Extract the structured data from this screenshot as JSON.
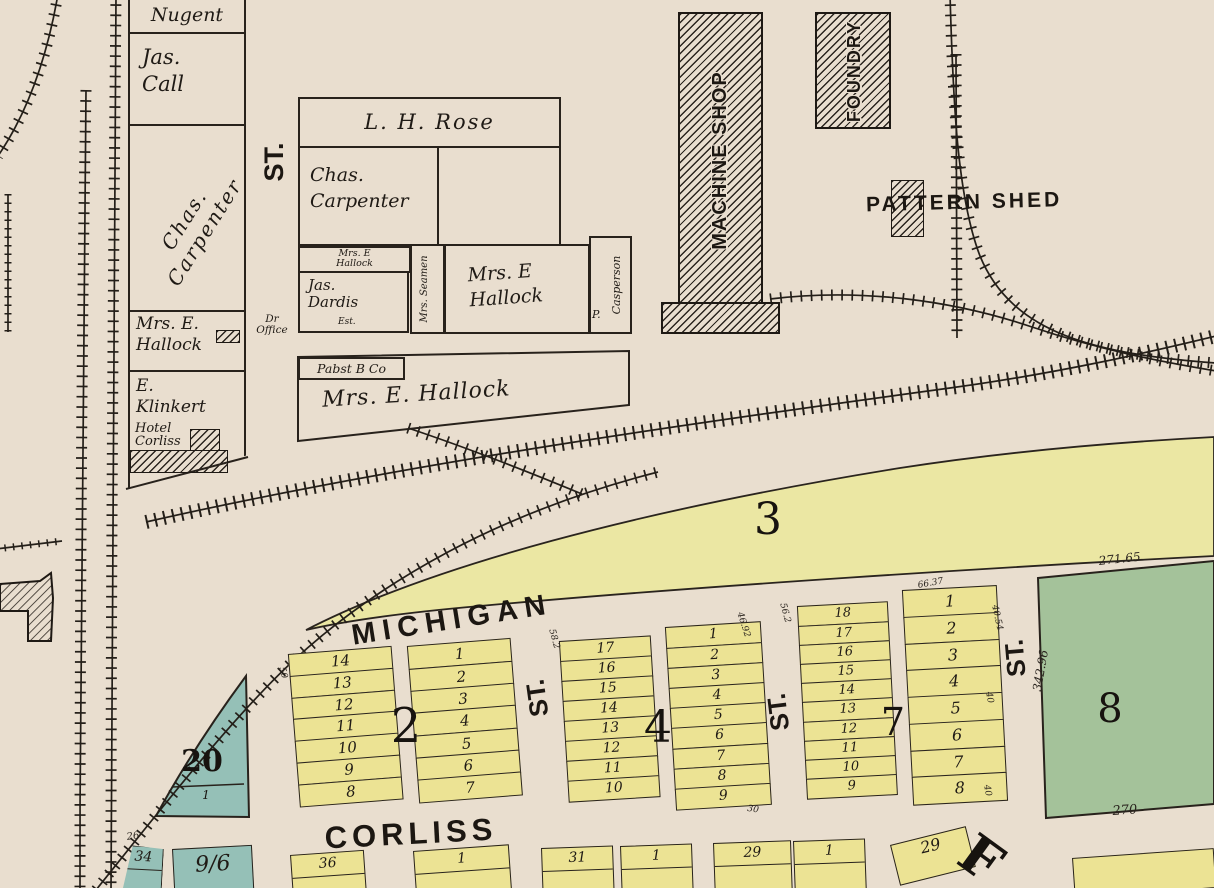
{
  "colors": {
    "paper": "#e9decf",
    "ink": "#231e18",
    "lot_yellow": "#ece394",
    "band_yellow": "#ebe7a3",
    "block_green": "#a4c29a",
    "block_teal": "#95c0b7"
  },
  "streets": {
    "michigan": "MICHIGAN",
    "corliss": "CORLISS",
    "st1": "ST.",
    "st2": "ST.",
    "st3": "ST.",
    "st4": "ST."
  },
  "buildings": {
    "machine_shop": "MACHINE SHOP",
    "foundry": "FOUNDRY",
    "pattern_shed": "PATTERN SHED",
    "dr_office": "Dr\nOffice"
  },
  "owners": {
    "nugent": "Nugent",
    "jas_call": "Jas.\nCall",
    "chas_carpenter_1": "Chas. Carpenter",
    "mrs_e_hallock_1": "Mrs. E.\nHallock",
    "e_klinkert": "E.\nKlinkert",
    "hotel_corliss": "Hotel\nCorliss",
    "l_h_rose": "L. H. Rose",
    "chas_carpenter_2": "Chas.\nCarpenter",
    "mrs_e_hallock_2": "Mrs. E\nHallock",
    "jas_dardis": "Jas.\nDardis",
    "jas_dardis_est": "Est.",
    "mrs_seamen": "Mrs. Seamen",
    "mrs_e_hallock_3": "Mrs. E\nHallock",
    "p_casperson_initial": "P.",
    "p_casperson": "Casperson",
    "pabst": "Pabst B Co",
    "mrs_e_hallock_4": "Mrs. E. Hallock"
  },
  "blocks": {
    "block2": {
      "label": "2",
      "left_lots": [
        "14",
        "13",
        "12",
        "11",
        "10",
        "9",
        "8"
      ],
      "right_lots": [
        "1",
        "2",
        "3",
        "4",
        "5",
        "6",
        "7"
      ]
    },
    "block3": {
      "label": "3"
    },
    "block4": {
      "label": "4",
      "left_lots": [
        "17",
        "16",
        "15",
        "14",
        "13",
        "12",
        "11",
        "10"
      ],
      "right_lots": [
        "1",
        "2",
        "3",
        "4",
        "5",
        "6",
        "7",
        "8",
        "9"
      ]
    },
    "block7": {
      "label": "7",
      "left_lots": [
        "18",
        "17",
        "16",
        "15",
        "14",
        "13",
        "12",
        "11",
        "10",
        "9"
      ],
      "right_lots": [
        "1",
        "2",
        "3",
        "4",
        "5",
        "6",
        "7",
        "8"
      ]
    },
    "block8": {
      "label": "8",
      "dim_top": "271.65",
      "dim_left": "342.96",
      "dim_bottom": "270"
    },
    "block20": {
      "label": "20",
      "lot": "1"
    }
  },
  "bottom_lots": {
    "b2a": "36",
    "b2b": "1",
    "b4a": "31",
    "b4b": "1",
    "b7a": "29",
    "b7b": "1",
    "tilted": "29"
  },
  "corner_lots": {
    "dim": "26",
    "a": "34",
    "b": "9/6"
  },
  "big_letter": "F",
  "dims": {
    "d1": "66.37",
    "d2": "40.54",
    "d3": "46.92",
    "d4": "40",
    "d5": "40",
    "d6": "30",
    "d7": "58.2",
    "d8": "56.2",
    "d9": "50"
  }
}
